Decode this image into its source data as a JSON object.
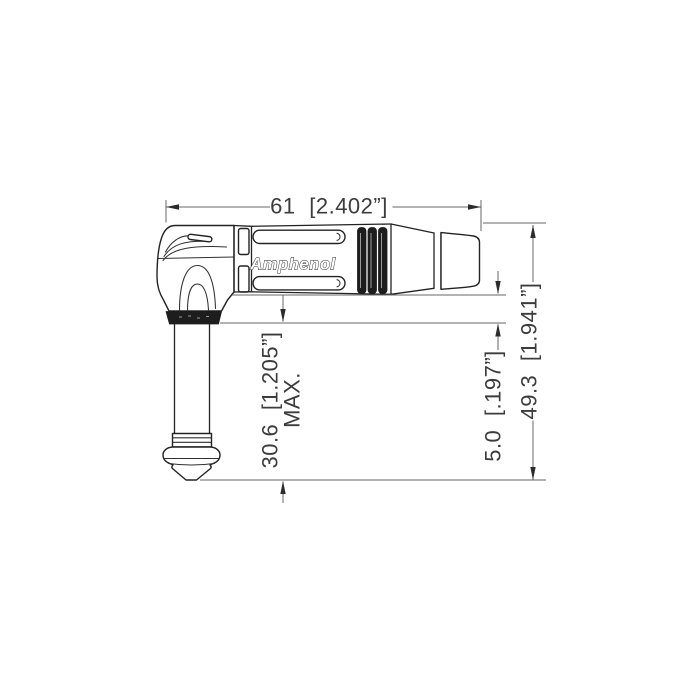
{
  "drawing": {
    "type": "technical-dimension-drawing",
    "subject": "right-angle 1/4 inch TS jack plug connector, side view",
    "part_brand": "Amphenol",
    "dimensions": [
      {
        "id": "overall-length",
        "label": "61 [2.402”]"
      },
      {
        "id": "plug-shaft-length",
        "label": "30.6 [1.205”]",
        "qualifier": "MAX."
      },
      {
        "id": "boot-offset",
        "label": "5.0 [.197”]"
      },
      {
        "id": "overall-height",
        "label": "49.3 [1.941”]"
      }
    ],
    "colors": {
      "background": "#ffffff",
      "part_outline": "#232323",
      "dark_fill": "#1d1d1d",
      "dimension_line": "#676767",
      "dimension_text": "#3c3c3c"
    }
  }
}
